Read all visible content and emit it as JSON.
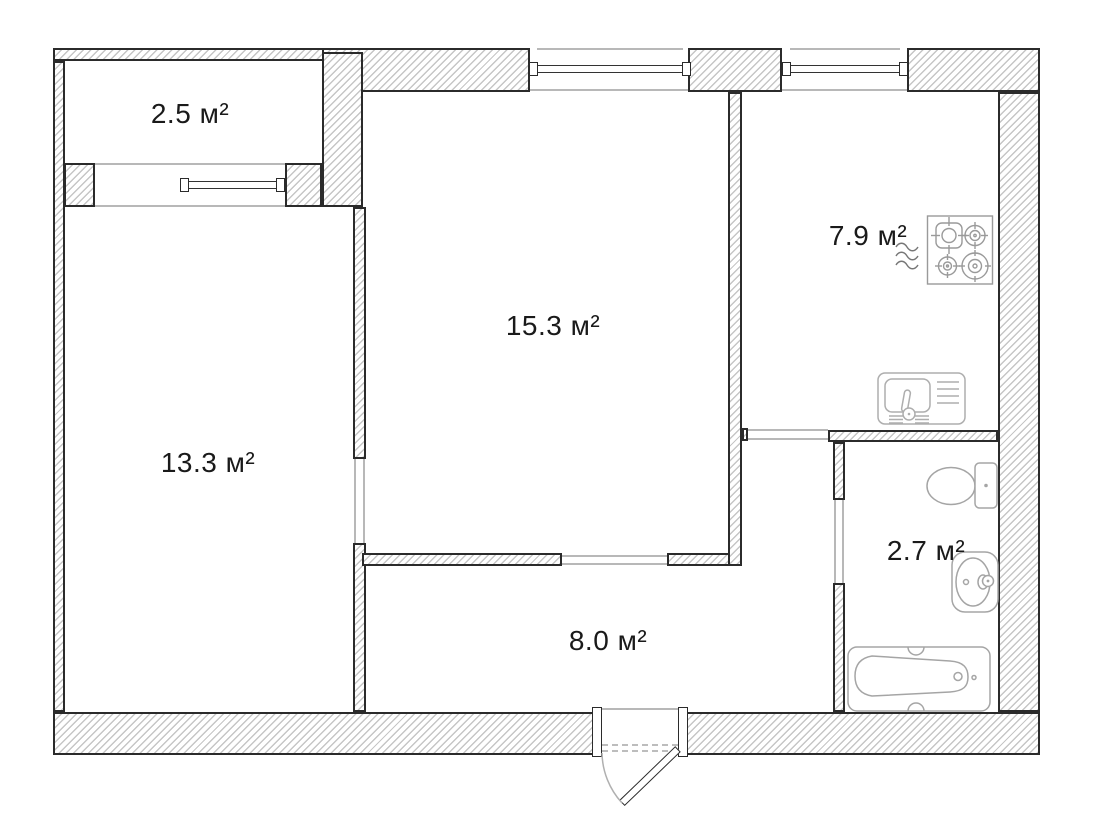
{
  "document": {
    "type": "floor-plan",
    "units": "м²"
  },
  "rooms": [
    {
      "id": "balcony",
      "label": "2.5 м²"
    },
    {
      "id": "living-room",
      "label": "13.3 м²"
    },
    {
      "id": "bedroom",
      "label": "15.3 м²"
    },
    {
      "id": "kitchen",
      "label": "7.9 м²"
    },
    {
      "id": "bathroom",
      "label": "2.7 м²"
    },
    {
      "id": "hallway",
      "label": "8.0 м²"
    }
  ],
  "fixtures": [
    {
      "name": "gas-stove-icon",
      "room": "kitchen"
    },
    {
      "name": "gas-waves-icon",
      "room": "kitchen"
    },
    {
      "name": "kitchen-sink-icon",
      "room": "kitchen"
    },
    {
      "name": "toilet-icon",
      "room": "bathroom"
    },
    {
      "name": "wash-basin-icon",
      "room": "bathroom"
    },
    {
      "name": "bathtub-icon",
      "room": "bathroom"
    },
    {
      "name": "entrance-door-icon",
      "room": "hallway"
    },
    {
      "name": "window-icon",
      "count": 3
    }
  ],
  "colors": {
    "wall_outline": "#2b2b2b",
    "wall_hatch": "#c6c6c6",
    "fixture_stroke": "#a5a5a5",
    "label_color": "#1a1a1a",
    "thin_line": "#b8b8b8"
  }
}
